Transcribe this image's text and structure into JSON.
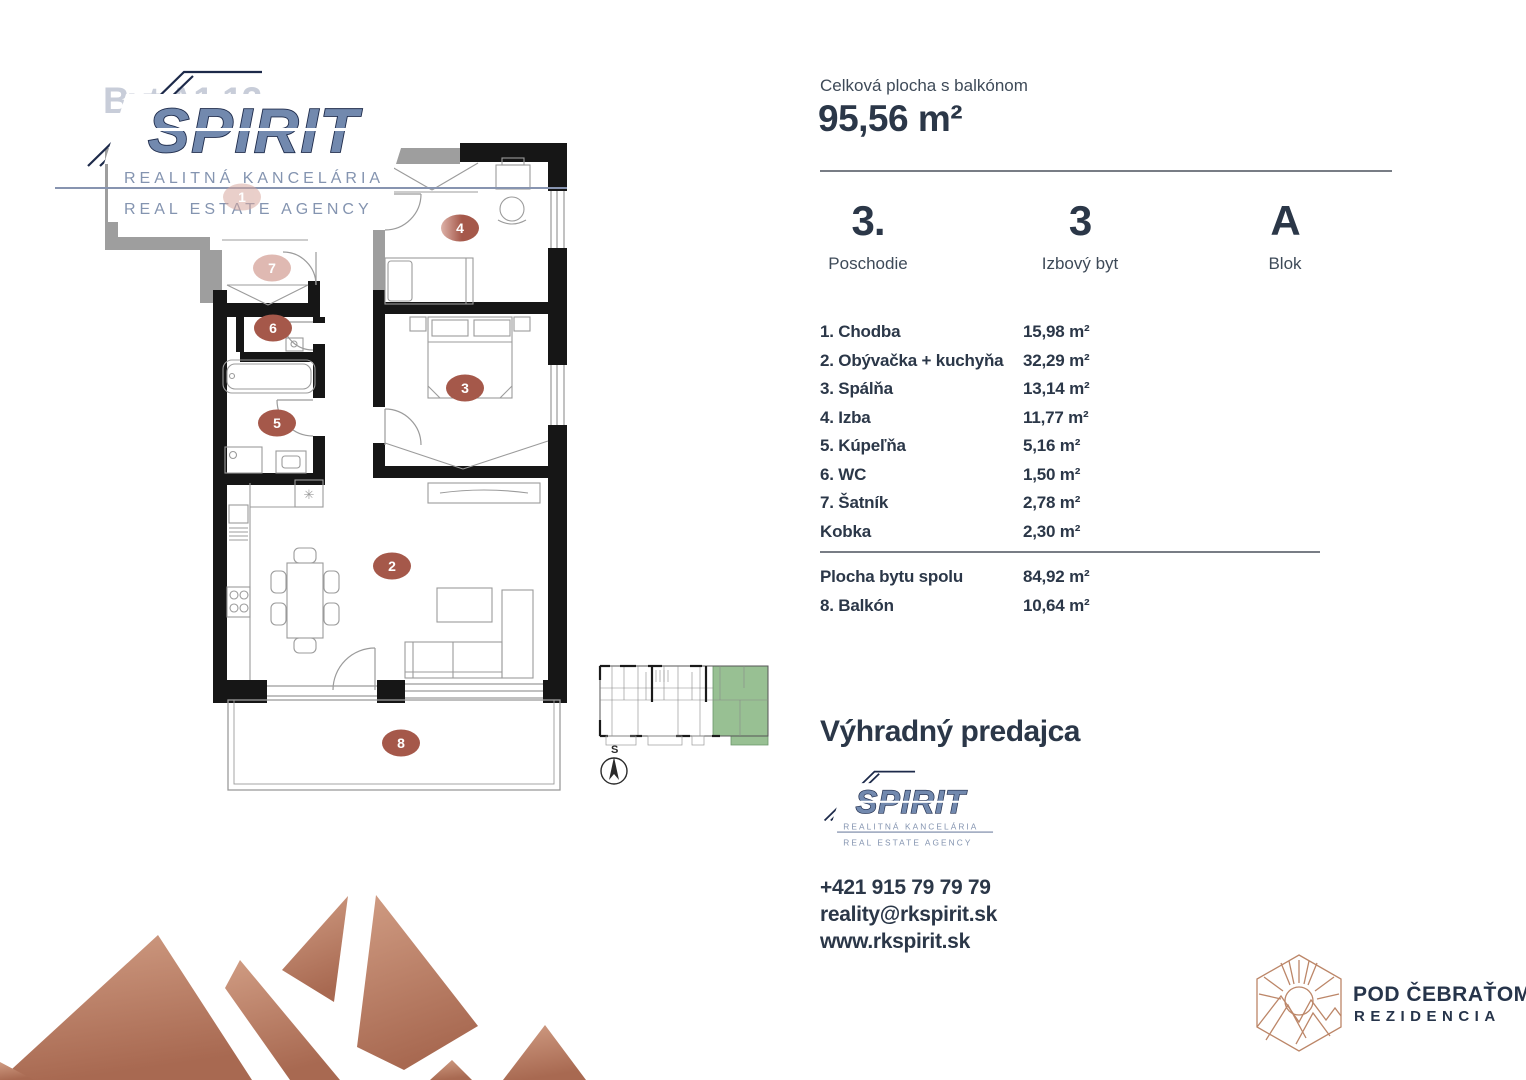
{
  "watermark": {
    "unit_label": "Byt A1.12"
  },
  "logo": {
    "brand": "SPIRIT",
    "line1": "REALITNÁ KANCELÁRIA",
    "line2": "REAL ESTATE AGENCY"
  },
  "summary": {
    "total_label": "Celková plocha s balkónom",
    "total_value": "95,56 m²",
    "attributes": [
      {
        "value": "3.",
        "label": "Poschodie"
      },
      {
        "value": "3",
        "label": "Izbový byt"
      },
      {
        "value": "A",
        "label": "Blok"
      }
    ]
  },
  "rooms": [
    {
      "label": "1. Chodba",
      "area": "15,98 m²"
    },
    {
      "label": "2. Obývačka + kuchyňa",
      "area": "32,29 m²"
    },
    {
      "label": "3. Spálňa",
      "area": "13,14 m²"
    },
    {
      "label": "4. Izba",
      "area": "11,77 m²"
    },
    {
      "label": "5. Kúpeľňa",
      "area": "5,16 m²"
    },
    {
      "label": "6. WC",
      "area": "1,50 m²"
    },
    {
      "label": "7. Šatník",
      "area": "2,78 m²"
    },
    {
      "label": "Kobka",
      "area": "2,30 m²"
    }
  ],
  "totals": [
    {
      "label": "Plocha bytu spolu",
      "area": "84,92 m²"
    },
    {
      "label": "8. Balkón",
      "area": "10,64 m²"
    }
  ],
  "seller": {
    "heading": "Výhradný predajca",
    "phone": "+421 915 79 79 79",
    "email": "reality@rkspirit.sk",
    "web": "www.rkspirit.sk"
  },
  "development": {
    "name": "POD ČEBRAŤOM",
    "subtitle": "REZIDENCIA"
  },
  "floorplan": {
    "badges": [
      "1",
      "2",
      "3",
      "4",
      "5",
      "6",
      "7",
      "8"
    ],
    "compass_label": "S"
  },
  "colors": {
    "navy_text": "#2b3748",
    "logo_blue": "#7289ae",
    "logo_outline": "#1d2a4a",
    "badge_brown": "#a5584a",
    "badge_light": "#d8a89f",
    "wall_black": "#161616",
    "wall_gray": "#9e9e9e",
    "miniplan_green": "#98c093",
    "copper": "#bc8668"
  }
}
